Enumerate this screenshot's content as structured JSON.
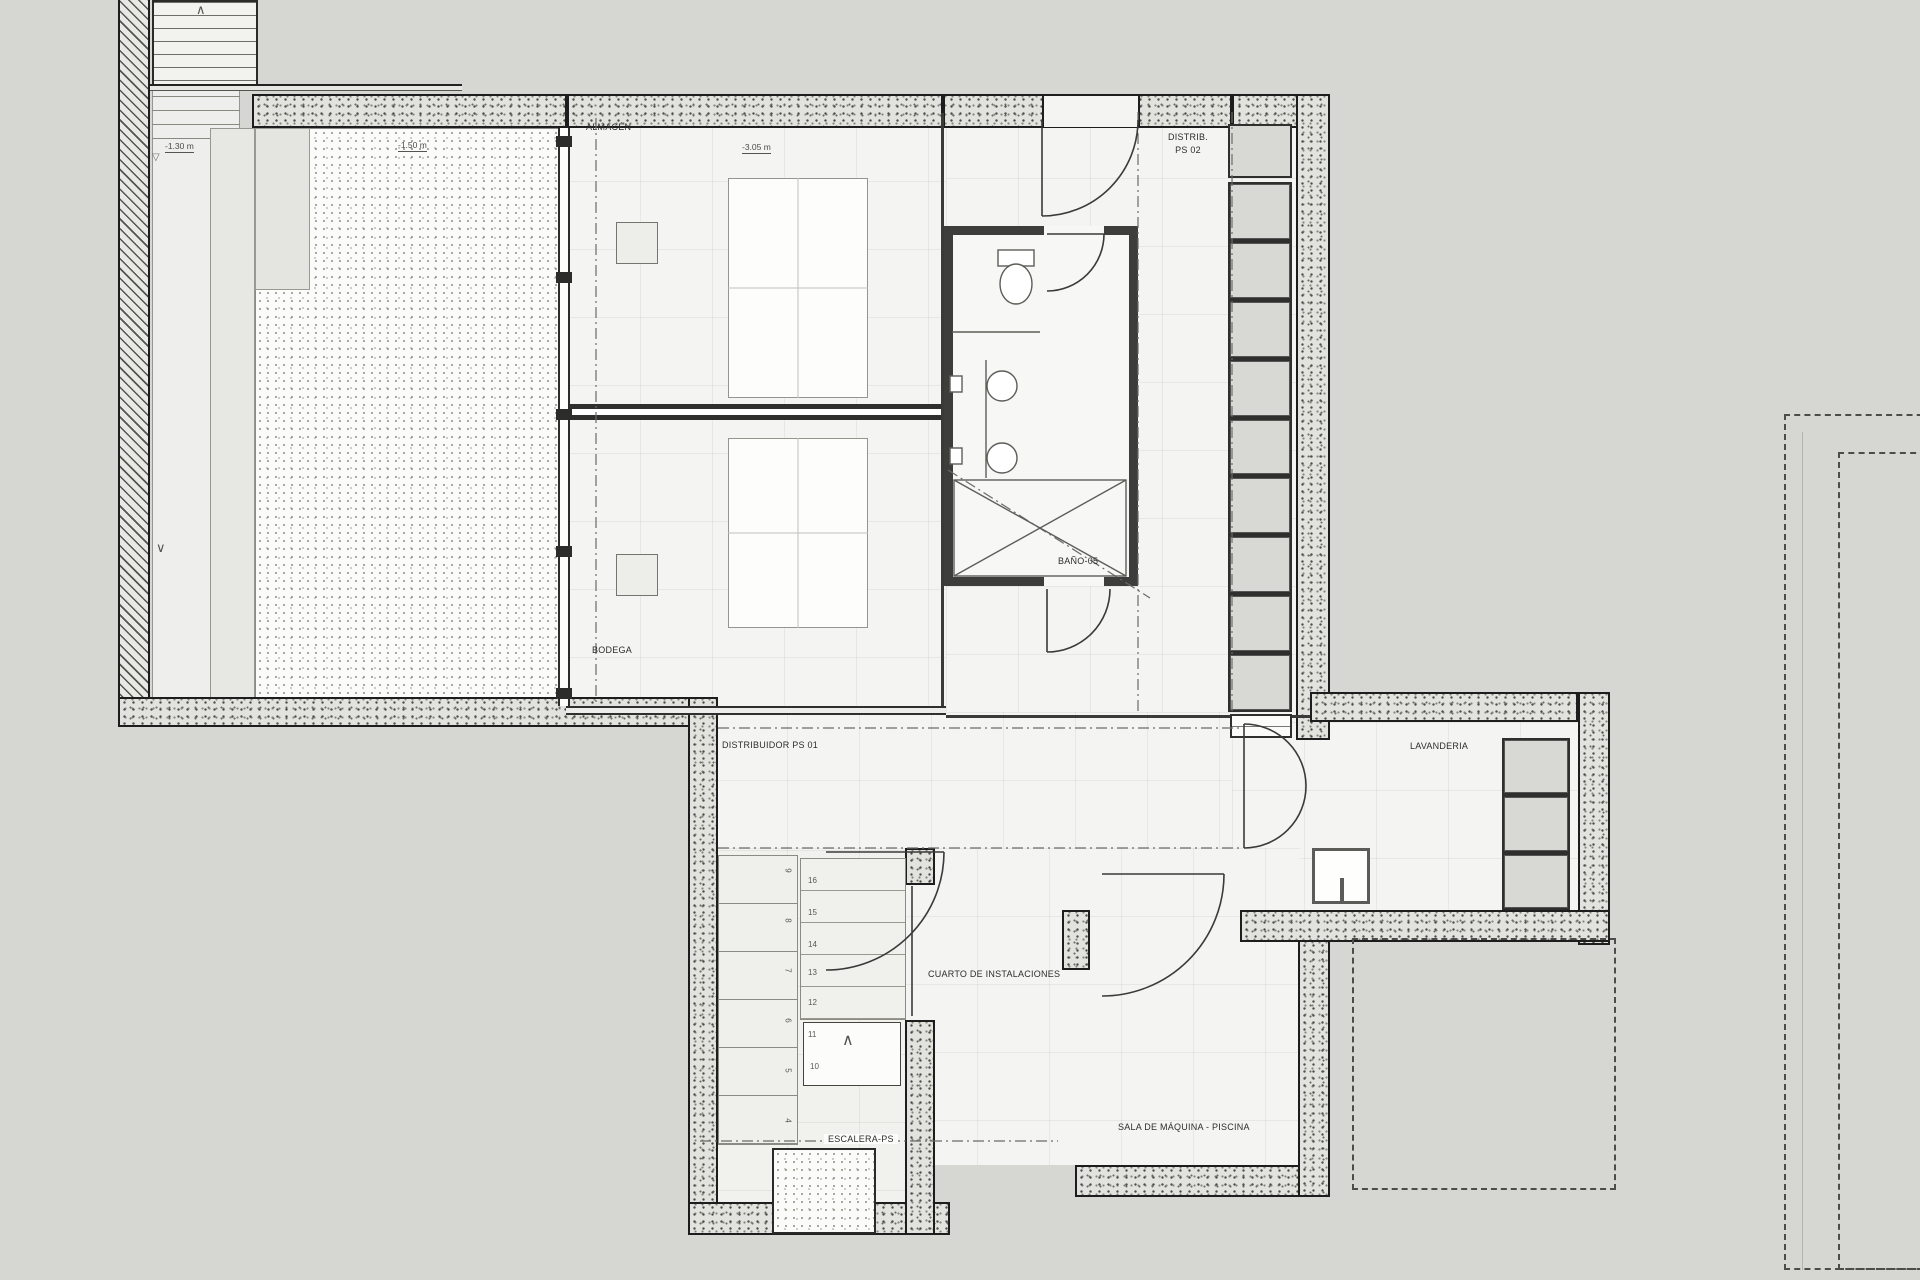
{
  "drawing": {
    "kind": "architectural basement floor plan",
    "language": "es"
  },
  "rooms": {
    "almacen": {
      "label": "ALMACÉN"
    },
    "bodega": {
      "label": "BODEGA"
    },
    "bano": {
      "label": "BAÑO-05"
    },
    "distrib_ps02": {
      "line1": "DISTRIB.",
      "line2": "PS 02"
    },
    "distribuidor_ps01": {
      "label": "DISTRIBUIDOR PS 01"
    },
    "lavanderia": {
      "label": "LAVANDERIA"
    },
    "cuarto": {
      "label": "CUARTO DE INSTALACIONES"
    },
    "escalera": {
      "label": "ESCALERA-PS"
    },
    "sala": {
      "label": "SALA DE MÁQUINA - PISCINA"
    }
  },
  "levels": {
    "exterior_ramp": "-1.30 m",
    "terrace": "-1.50 m",
    "interior": "-3.05 m",
    "marker_icon": "▽"
  },
  "stairs": {
    "main_numbers": [
      "16",
      "15",
      "14",
      "13",
      "12",
      "11",
      "10"
    ],
    "side_numbers": [
      "9",
      "8",
      "7",
      "6",
      "5",
      "4"
    ],
    "up_arrow": "∧",
    "down_arrow": "∨"
  },
  "colors": {
    "background": "#d6d6d3",
    "floor": "#f4f4f2",
    "wall_edge": "#1d1d1d",
    "wall_fill": "#e2e2df",
    "dark_partition": "#3d3d3c",
    "shelf_fill": "#d8d8d5"
  }
}
